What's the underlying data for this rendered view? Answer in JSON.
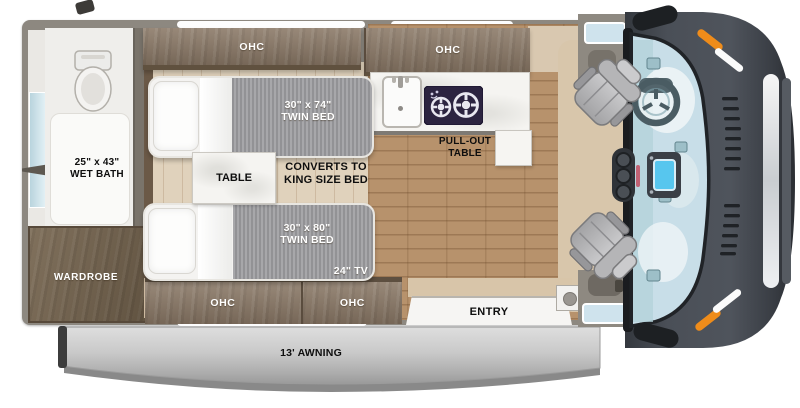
{
  "plan": {
    "overhead_cabinets": [
      "OHC",
      "OHC",
      "OHC",
      "OHC"
    ],
    "wet_bath": {
      "size": "25\" x 43\"",
      "name": "WET BATH"
    },
    "wardrobe": "WARDROBE",
    "bed_front": {
      "size": "30\" x 74\"",
      "type": "TWIN BED"
    },
    "bed_rear": {
      "size": "30\" x 80\"",
      "type": "TWIN BED"
    },
    "table": "TABLE",
    "converts": {
      "line1": "CONVERTS TO",
      "line2": "KING SIZE BED"
    },
    "pullout": {
      "line1": "PULL-OUT",
      "line2": "TABLE"
    },
    "tv": "24\" TV",
    "entry": "ENTRY",
    "awning": "13' AWNING"
  },
  "colors": {
    "wood_cabinet": "#8a7866",
    "wood_wardrobe": "#76654f",
    "floor_main": "#b7926c",
    "floor_bed_area": "#e0d2bc",
    "mattress_gray": "#9d9da0",
    "wall_gray": "#8d8880",
    "counter_white": "#f5f4f1",
    "cooktop_dark": "#2c2440",
    "awning_gray": "#c4c4c4",
    "van_body_gray": "#454a52",
    "windshield_blue": "#c8dee8",
    "marker_orange": "#ef8c1a"
  }
}
